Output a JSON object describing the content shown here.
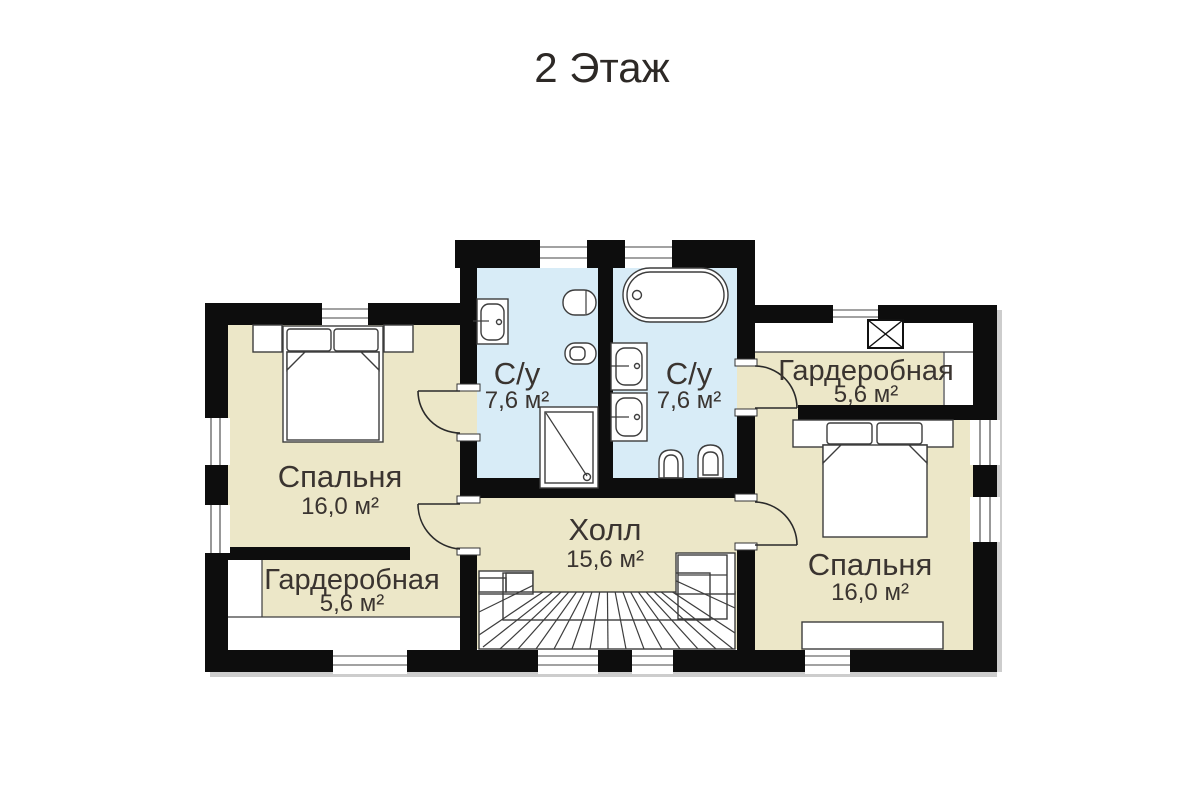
{
  "title": "2 Этаж",
  "colors": {
    "wall": "#0d0d0d",
    "room_beige": "#ece7c8",
    "bathroom_blue": "#d8ecf7",
    "line": "#3d3d3d",
    "text": "#3a3430",
    "background": "#ffffff",
    "shadow": "#cdcdcd"
  },
  "rooms": {
    "bedroom_left": {
      "label": "Спальня",
      "area": "16,0 м²"
    },
    "wardrobe_left": {
      "label": "Гардеробная",
      "area": "5,6 м²"
    },
    "bathroom_left": {
      "label": "С/у",
      "area": "7,6 м²"
    },
    "bathroom_right": {
      "label": "С/у",
      "area": "7,6 м²"
    },
    "wardrobe_right": {
      "label": "Гардеробная",
      "area": "5,6 м²"
    },
    "bedroom_right": {
      "label": "Спальня",
      "area": "16,0 м²"
    },
    "hall": {
      "label": "Холл",
      "area": "15,6 м²"
    }
  },
  "fixtures": [
    "double-bed",
    "nightstand",
    "sink",
    "toilet",
    "bidet",
    "shower-cabin",
    "bathtub",
    "winder-stairs",
    "vent-shaft",
    "closet"
  ]
}
